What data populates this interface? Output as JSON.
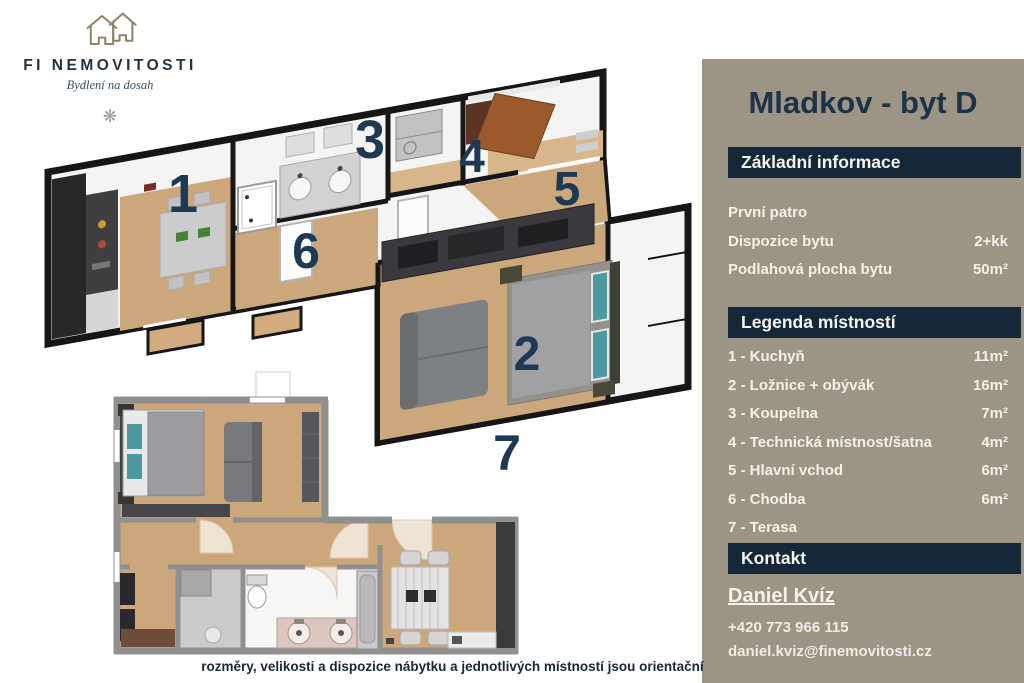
{
  "logo": {
    "brand": "FI NEMOVITOSTI",
    "tagline": "Bydlení na dosah",
    "ornament": "❋"
  },
  "panel": {
    "title": "Mladkov - byt D",
    "basic_info": {
      "header": "Základní informace",
      "rows": [
        {
          "label": "První patro",
          "value": ""
        },
        {
          "label": "Dispozice bytu",
          "value": "2+kk"
        },
        {
          "label": "Podlahová plocha bytu",
          "value": "50m²"
        }
      ]
    },
    "legend": {
      "header": "Legenda místností",
      "rows": [
        {
          "label": "1 - Kuchyň",
          "value": "11m²"
        },
        {
          "label": "2 - Ložnice + obývák",
          "value": "16m²"
        },
        {
          "label": "3 - Koupelna",
          "value": "7m²"
        },
        {
          "label": "4 - Technická místnost/šatna",
          "value": "4m²"
        },
        {
          "label": "5 - Hlavní vchod",
          "value": "6m²"
        },
        {
          "label": "6 - Chodba",
          "value": "6m²"
        },
        {
          "label": "7 - Terasa",
          "value": ""
        }
      ]
    },
    "contact": {
      "header": "Kontakt",
      "name": "Daniel Kvíz",
      "phone": "+420 773 966 115",
      "email": "daniel.kviz@finemovitosti.cz"
    }
  },
  "floorplan": {
    "room_labels": [
      "1",
      "2",
      "3",
      "4",
      "5",
      "6",
      "7"
    ],
    "disclaimer": "rozměry, velikosti a dispozice nábytku a jednotlivých místností jsou orientační"
  },
  "colors": {
    "panel_bg": "#9c9484",
    "banner_bg": "#15283a",
    "title_text": "#1d3349",
    "room_number": "#1d3a55",
    "wood_floor": "#cda77c",
    "wall_3d": "#161616",
    "wall_2d": "#909090",
    "bed_teal": "#4e98a0",
    "door_brown": "#9a5a2c"
  }
}
